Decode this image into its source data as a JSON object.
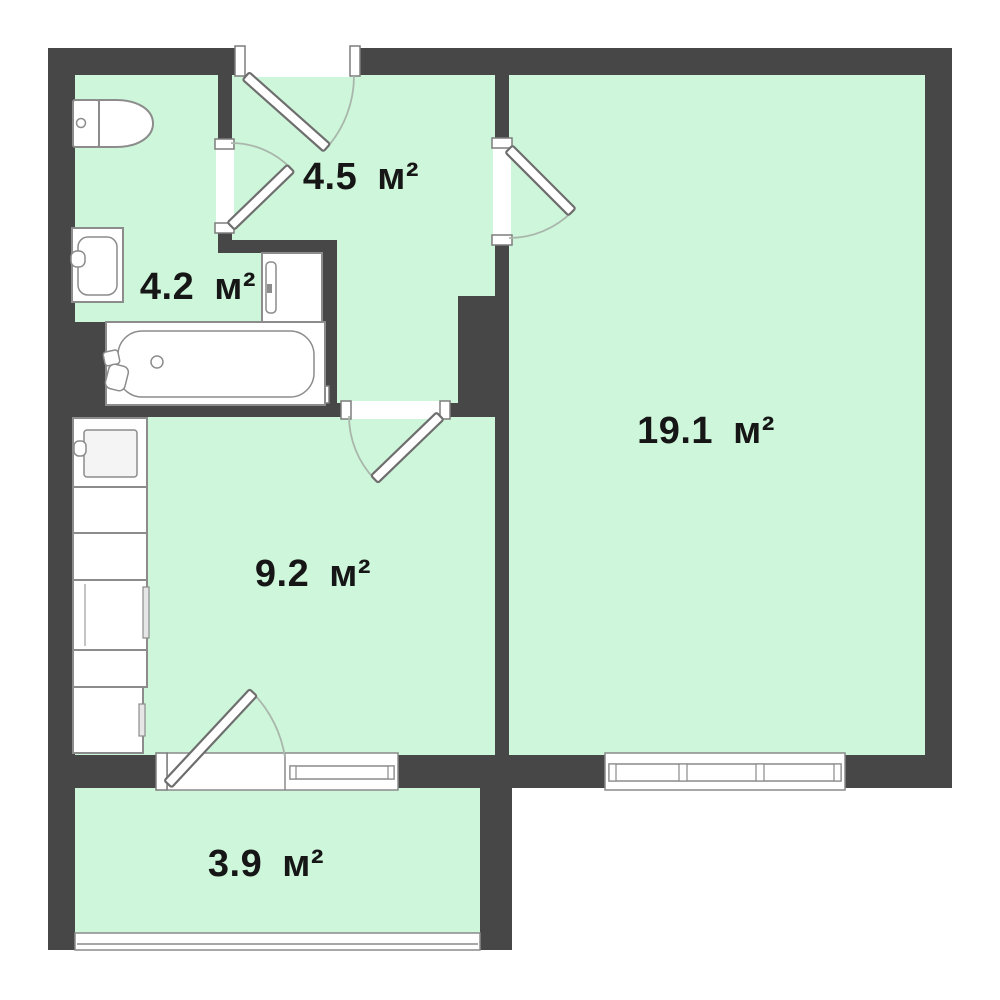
{
  "plan": {
    "type": "apartment-floor-plan",
    "rooms": [
      {
        "key": "hallway",
        "area_label": "4.5 м²"
      },
      {
        "key": "bathroom",
        "area_label": "4.2 м²"
      },
      {
        "key": "living-room",
        "area_label": "19.1 м²"
      },
      {
        "key": "kitchen",
        "area_label": "9.2 м²"
      },
      {
        "key": "balcony",
        "area_label": "3.9 м²"
      }
    ],
    "fixtures": [
      {
        "name": "toilet"
      },
      {
        "name": "bathroom-sink"
      },
      {
        "name": "bathtub"
      },
      {
        "name": "washing-machine"
      },
      {
        "name": "kitchen-sink-unit"
      },
      {
        "name": "counter-unit"
      },
      {
        "name": "stove-unit"
      },
      {
        "name": "fridge"
      }
    ],
    "doors": [
      {
        "name": "entrance-door"
      },
      {
        "name": "bathroom-door"
      },
      {
        "name": "living-room-door"
      },
      {
        "name": "kitchen-door"
      },
      {
        "name": "balcony-door"
      }
    ],
    "windows": [
      {
        "name": "kitchen-window"
      },
      {
        "name": "living-room-window"
      },
      {
        "name": "balcony-glazing"
      }
    ],
    "colors": {
      "wall": "#474747",
      "floor": "#cef6da",
      "fixture": "#ffffff",
      "outline": "#8c8c8c",
      "arc": "#a9b6ac",
      "text": "#161616",
      "background": "#ffffff"
    }
  }
}
